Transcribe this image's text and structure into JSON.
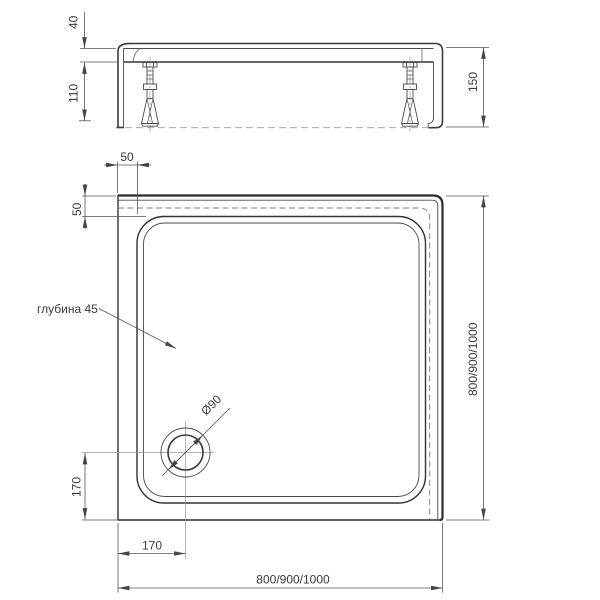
{
  "drawing": {
    "side_view": {
      "rim_height": "40",
      "frame_height": "110",
      "total_height": "150"
    },
    "plan_view": {
      "edge_offset_top": "50",
      "edge_offset_left": "50",
      "depth_note": "глубина 45",
      "drain_diameter": "Ø90",
      "drain_offset_vertical": "170",
      "drain_offset_horizontal": "170",
      "overall_width": "800/900/1000",
      "overall_depth": "800/900/1000"
    },
    "colors": {
      "line": "#333333",
      "dimension": "#555555",
      "hidden": "#7d7d7d",
      "background": "#ffffff"
    }
  }
}
